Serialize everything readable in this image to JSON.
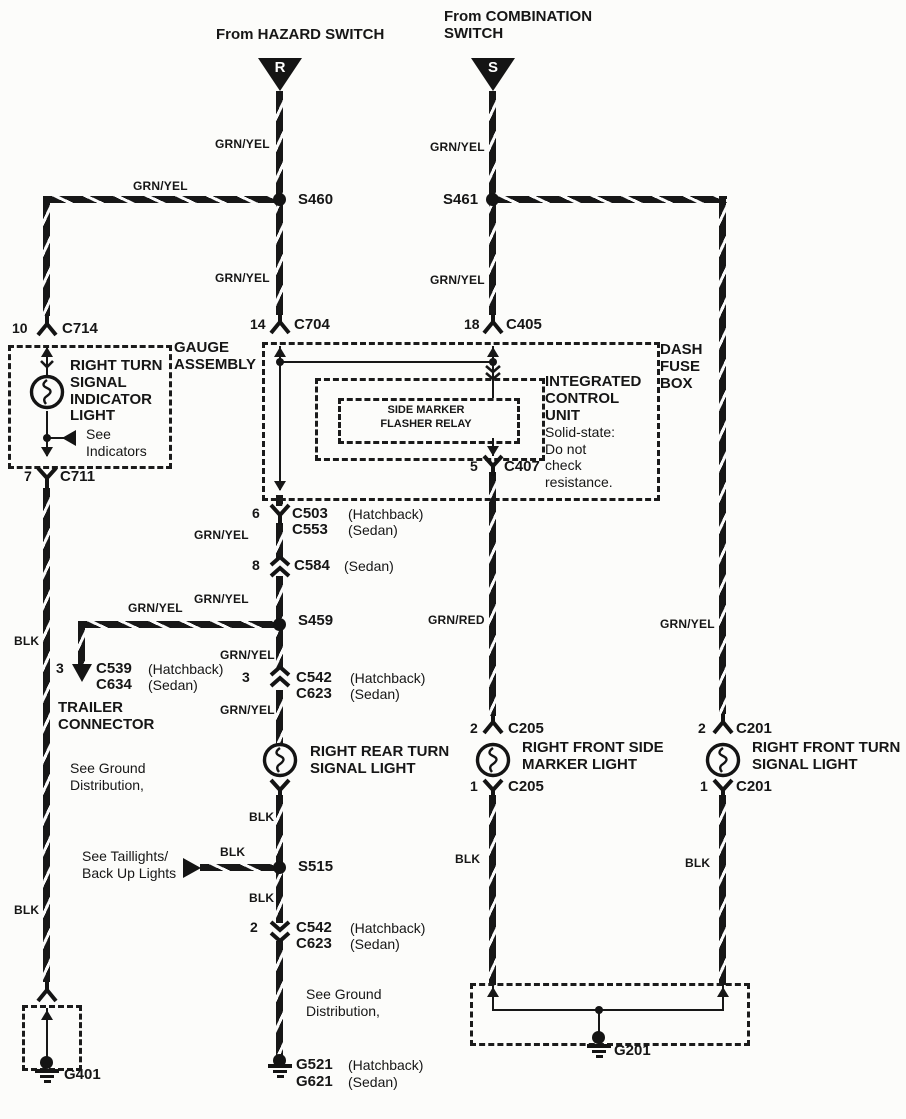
{
  "meta": {
    "ink": "#161616",
    "paper": "#fcfcfa",
    "diagram": "turn-signal-wiring"
  },
  "sources": {
    "hazard": "From HAZARD SWITCH",
    "combination": "From COMBINATION\nSWITCH",
    "r": "R",
    "s": "S"
  },
  "colors": {
    "grn_yel": "GRN/YEL",
    "grn_red": "GRN/RED",
    "blk": "BLK"
  },
  "splices": {
    "s460": "S460",
    "s461": "S461",
    "s459": "S459",
    "s515": "S515"
  },
  "connectors": {
    "c714": {
      "pin": "10",
      "name": "C714"
    },
    "c711": {
      "pin": "7",
      "name": "C711"
    },
    "c704": {
      "pin": "14",
      "name": "C704"
    },
    "c405": {
      "pin": "18",
      "name": "C405"
    },
    "c407": {
      "pin": "5",
      "name": "C407"
    },
    "c503": {
      "pin": "6",
      "name": "C503",
      "variant": "(Hatchback)",
      "alt": "C553",
      "alt_variant": "(Sedan)"
    },
    "c584": {
      "pin": "8",
      "name": "C584",
      "variant": "(Sedan)"
    },
    "c539": {
      "pin": "3",
      "name": "C539",
      "variant": "(Hatchback)",
      "alt": "C634",
      "alt_variant": "(Sedan)"
    },
    "c542_upper": {
      "pin": "3",
      "name": "C542",
      "variant": "(Hatchback)",
      "alt": "C623",
      "alt_variant": "(Sedan)"
    },
    "c542_lower": {
      "pin": "2",
      "name": "C542",
      "variant": "(Hatchback)",
      "alt": "C623",
      "alt_variant": "(Sedan)"
    },
    "c205_top": {
      "pin": "2",
      "name": "C205"
    },
    "c205_bottom": {
      "pin": "1",
      "name": "C205"
    },
    "c201_top": {
      "pin": "2",
      "name": "C201"
    },
    "c201_bottom": {
      "pin": "1",
      "name": "C201"
    }
  },
  "components": {
    "gauge_assembly": "GAUGE\nASSEMBLY",
    "dash_fuse_box": "DASH\nFUSE\nBOX",
    "indicator_light": "RIGHT TURN\nSIGNAL\nINDICATOR\nLIGHT",
    "icu_name": "INTEGRATED\nCONTROL\nUNIT",
    "icu_note": "Solid-state:\nDo not\ncheck\nresistance.",
    "relay": "SIDE MARKER\nFLASHER RELAY",
    "rear_turn_light": "RIGHT REAR TURN\nSIGNAL LIGHT",
    "side_marker_light": "RIGHT FRONT SIDE\nMARKER LIGHT",
    "front_turn_light": "RIGHT FRONT TURN\nSIGNAL LIGHT",
    "trailer_connector": "TRAILER\nCONNECTOR"
  },
  "notes": {
    "see_indicators": "See\nIndicators",
    "see_ground": "See Ground\nDistribution,",
    "see_taillights": "See Taillights/\nBack Up Lights"
  },
  "grounds": {
    "g401": "G401",
    "g201": "G201",
    "g521": {
      "name": "G521",
      "variant": "(Hatchback)",
      "alt": "G621",
      "alt_variant": "(Sedan)"
    }
  }
}
